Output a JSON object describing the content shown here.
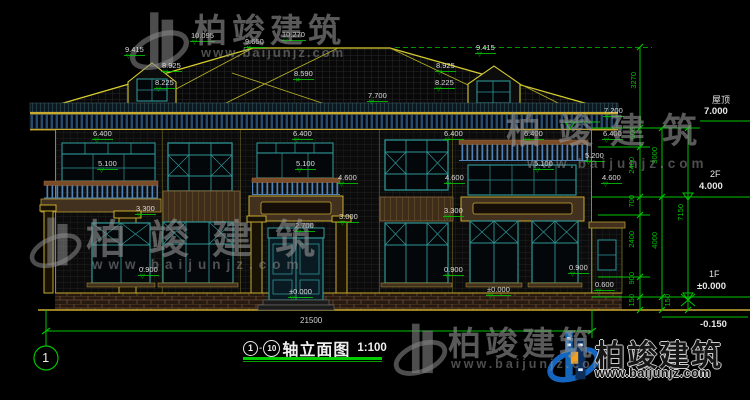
{
  "colors": {
    "dim_green": "#00c400",
    "cad_yellow": "#c9ab30",
    "window_teal": "#2e9494",
    "label_white": "#dcdcdc",
    "watermark_gray": "#949494",
    "brand_blue": "#1466b8",
    "brand_orange": "#f2a01e"
  },
  "drawing": {
    "title": {
      "axis_start": "1",
      "dash": "-",
      "axis_end": "10",
      "name": "轴立面图",
      "scale": "1:100"
    },
    "axis_bubble_label": "1",
    "total_width_dim": "21500",
    "levels": {
      "roof": {
        "label": "屋顶",
        "value": "7.000"
      },
      "floor2": {
        "label": "2F",
        "value": "4.000"
      },
      "floor1": {
        "label": "1F",
        "value": "±0.000"
      },
      "ground": {
        "value": "-0.150"
      }
    },
    "annotations": [
      {
        "text": "9.415",
        "x": 124,
        "y": 46,
        "marker": "t"
      },
      {
        "text": "8.925",
        "x": 161,
        "y": 62,
        "marker": "t"
      },
      {
        "text": "8.225",
        "x": 154,
        "y": 79,
        "marker": "t"
      },
      {
        "text": "10.095",
        "x": 190,
        "y": 32,
        "marker": "t"
      },
      {
        "text": "9.650",
        "x": 244,
        "y": 38,
        "marker": "x"
      },
      {
        "text": "10.270",
        "x": 281,
        "y": 31,
        "marker": "t"
      },
      {
        "text": "8.590",
        "x": 293,
        "y": 70,
        "marker": "x"
      },
      {
        "text": "7.700",
        "x": 367,
        "y": 92,
        "marker": "t"
      },
      {
        "text": "9.415",
        "x": 475,
        "y": 44,
        "marker": "t"
      },
      {
        "text": "8.925",
        "x": 435,
        "y": 62,
        "marker": "t"
      },
      {
        "text": "8.225",
        "x": 434,
        "y": 79,
        "marker": "t"
      },
      {
        "text": "7.200",
        "x": 603,
        "y": 107,
        "marker": "t"
      },
      {
        "text": "6.400",
        "x": 92,
        "y": 130,
        "marker": "t"
      },
      {
        "text": "6.400",
        "x": 292,
        "y": 130,
        "marker": "t"
      },
      {
        "text": "6.400",
        "x": 443,
        "y": 130,
        "marker": "t"
      },
      {
        "text": "6.400",
        "x": 523,
        "y": 130,
        "marker": "t"
      },
      {
        "text": "6.400",
        "x": 602,
        "y": 130,
        "marker": "t"
      },
      {
        "text": "5.100",
        "x": 97,
        "y": 160,
        "marker": "t"
      },
      {
        "text": "5.100",
        "x": 295,
        "y": 160,
        "marker": "t"
      },
      {
        "text": "5.100",
        "x": 533,
        "y": 160,
        "marker": "t"
      },
      {
        "text": "5.200",
        "x": 584,
        "y": 152,
        "marker": "t"
      },
      {
        "text": "4.600",
        "x": 337,
        "y": 174,
        "marker": "t"
      },
      {
        "text": "4.600",
        "x": 444,
        "y": 174,
        "marker": "t"
      },
      {
        "text": "4.600",
        "x": 601,
        "y": 174,
        "marker": "t"
      },
      {
        "text": "3.300",
        "x": 135,
        "y": 205,
        "marker": "t"
      },
      {
        "text": "3.300",
        "x": 443,
        "y": 207,
        "marker": "t"
      },
      {
        "text": "3.000",
        "x": 338,
        "y": 213,
        "marker": "t"
      },
      {
        "text": "2.700",
        "x": 294,
        "y": 222,
        "marker": "t"
      },
      {
        "text": "0.900",
        "x": 138,
        "y": 266,
        "marker": "t"
      },
      {
        "text": "0.900",
        "x": 443,
        "y": 266,
        "marker": "t"
      },
      {
        "text": "0.900",
        "x": 568,
        "y": 264,
        "marker": "t"
      },
      {
        "text": "±0.000",
        "x": 288,
        "y": 288,
        "marker": "t"
      },
      {
        "text": "±0.000",
        "x": 486,
        "y": 286,
        "marker": "t"
      },
      {
        "text": "0.600",
        "x": 594,
        "y": 281,
        "marker": "t"
      }
    ],
    "vertical_dims": [
      {
        "text": "3270",
        "x": 630,
        "y": 72
      },
      {
        "text": "600",
        "x": 629,
        "y": 127
      },
      {
        "text": "2400",
        "x": 628,
        "y": 157
      },
      {
        "text": "700",
        "x": 628,
        "y": 195
      },
      {
        "text": "2400",
        "x": 628,
        "y": 231
      },
      {
        "text": "900",
        "x": 628,
        "y": 272
      },
      {
        "text": "150",
        "x": 628,
        "y": 294
      },
      {
        "text": "3000",
        "x": 651,
        "y": 147
      },
      {
        "text": "4000",
        "x": 651,
        "y": 232
      },
      {
        "text": "150",
        "x": 664,
        "y": 294
      },
      {
        "text": "7150",
        "x": 677,
        "y": 204
      }
    ]
  },
  "watermarks": {
    "top": {
      "text": "柏竣建筑",
      "url": "www.baijunjz.com"
    },
    "right": {
      "text": "柏竣建筑",
      "url": "www.baijunjz.com"
    },
    "middle_left": {
      "text": "柏竣建筑",
      "url": "www.baijunjz.com"
    },
    "bottom_center": {
      "text": "柏竣建筑",
      "url": "www.baijunjz.com"
    },
    "brand": {
      "text": "柏竣建筑",
      "url": "www.baijunjz.com"
    }
  }
}
